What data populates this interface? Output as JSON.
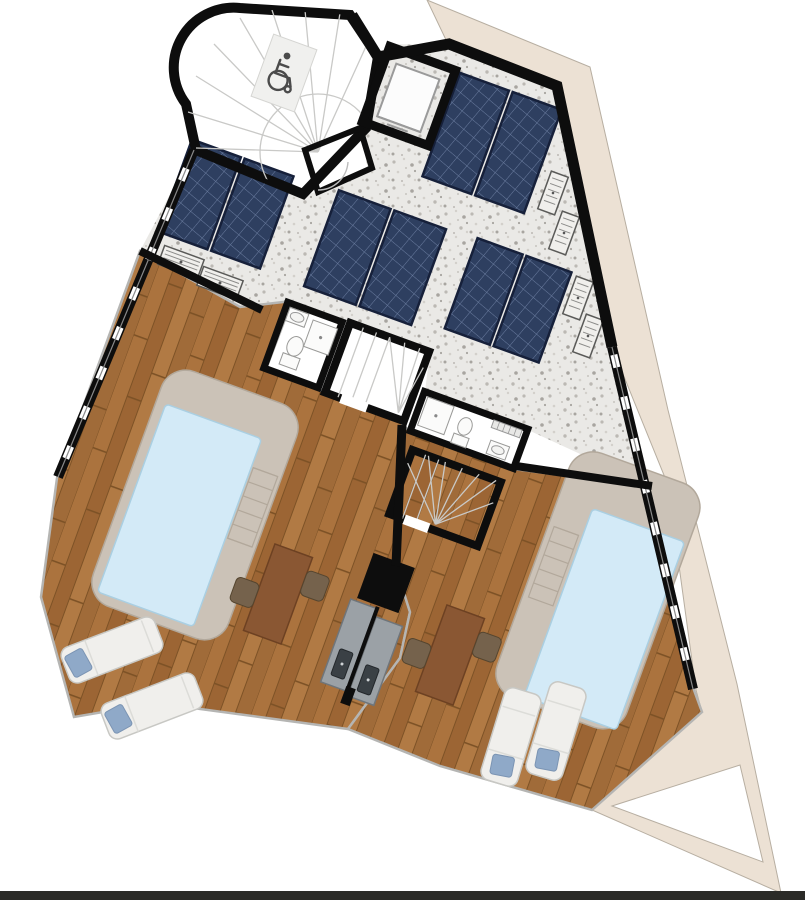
{
  "meta": {
    "type": "architectural-floor-plan",
    "view": "roof-terrace-level-top-view",
    "visible_text": []
  },
  "colors": {
    "background": "#ffffff",
    "neighbor_roof": "#ece1d4",
    "neighbor_roof_edge": "#b7aea1",
    "wall": "#0d0d0d",
    "gravel_base": "#eae9e6",
    "gravel_dot_dark": "#a8a5a0",
    "gravel_dot_mid": "#bcb9b4",
    "gravel_dot_light": "#d3d0cb",
    "solar_cell": "#2e3f60",
    "solar_grid": "#6b7da0",
    "solar_frame": "#16203a",
    "wood_base": "#a9713c",
    "wood_plank_a": "#ab733e",
    "wood_plank_b": "#9c6534",
    "wood_plank_c": "#b17a44",
    "wood_plank_d": "#a06b39",
    "wood_line": "#7d5226",
    "stone": "#cbc2b7",
    "stone_edge": "#b2a89b",
    "water": "#d3eaf7",
    "water_edge": "#aacfe2",
    "tile": "#dfdbd5",
    "tile_line": "#c6c1ba",
    "fixture_white": "#fbfbfa",
    "fixture_edge": "#9a9a98",
    "lounger": "#f0efec",
    "lounger_edge": "#c8c8c4",
    "pillow": "#8fa9c8",
    "table_wood": "#8a5733",
    "table_edge": "#6d4122",
    "chair": "#75624c",
    "chair_edge": "#55452f",
    "counter": "#9ba1a6",
    "counter_edge": "#6f757a",
    "sink_dark": "#3a4045",
    "railing": "#b5b5b3",
    "step_line": "#c9c9c7",
    "card": "#f0f0ee",
    "icon_stroke": "#4b4b4b",
    "bottom_bar": "#2b2b28"
  },
  "features": {
    "stair_tower": {
      "type": "curved-winder-staircase",
      "accessible": true,
      "icon": "wheelchair-icon"
    },
    "elevator": {
      "count": 1
    },
    "solar_panel_pairs": {
      "count": 4,
      "panels_total": 8
    },
    "ac_units": {
      "count": 6
    },
    "bathrooms": {
      "count": 2,
      "fixtures": [
        "sink",
        "shower",
        "toilet"
      ]
    },
    "interior_stairs": {
      "count": 2
    },
    "pools": {
      "count": 2,
      "surround": "stone",
      "steps": true
    },
    "sun_loungers": {
      "count": 4,
      "pillow_color": "#8fa9c8"
    },
    "dining_tables": {
      "count": 2,
      "chairs_each": 2
    },
    "bbq_counters": {
      "count": 2,
      "sinks": 2
    },
    "terraces": {
      "count": 2,
      "flooring": "wood-deck"
    },
    "roof_area": {
      "flooring": "gravel"
    },
    "neighbor_roof_outline": true
  },
  "icons": [
    {
      "name": "wheelchair-icon",
      "meaning": "accessible stair / lift lobby"
    }
  ]
}
